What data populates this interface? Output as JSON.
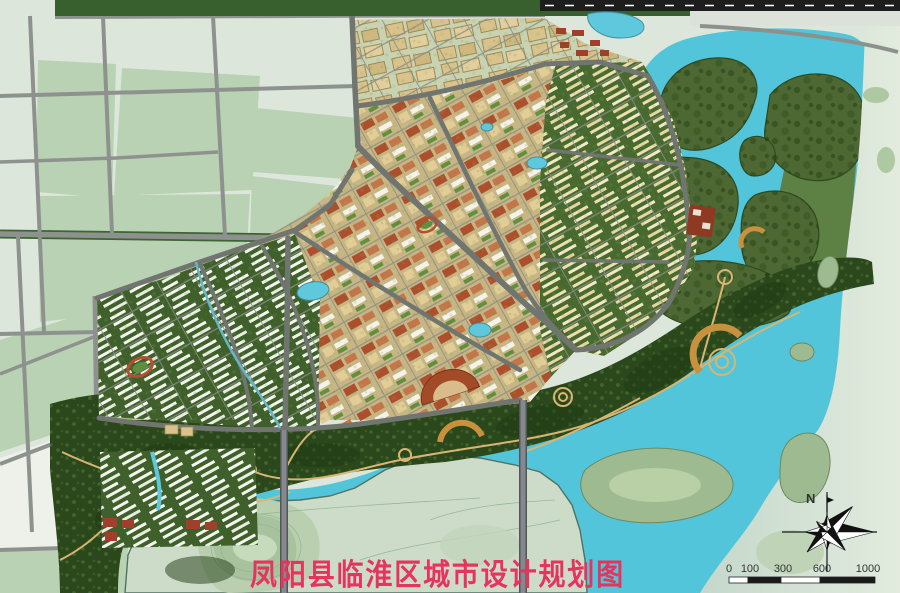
{
  "map": {
    "title": "凤阳县临淮区城市设计规划图",
    "compass": {
      "label": "N"
    },
    "scale_bar": {
      "unit_labels": [
        "0",
        "100",
        "300",
        "600",
        "1000"
      ]
    },
    "palette": {
      "field_pale": "#dde6da",
      "field_sage": "#b9d2b3",
      "water_cyan": "#52c5da",
      "park_green": "#2b471c",
      "wetland_island_green": "#4d6833",
      "terrain_pale": "#cddcc9",
      "urban_tan": "#c8b584",
      "roof_terracotta": "#ad4f2c",
      "road_gray": "#8e928e",
      "highway_dark": "#1d1d1d",
      "path_tan": "#d8b572",
      "title_red": "#e5345e"
    }
  }
}
